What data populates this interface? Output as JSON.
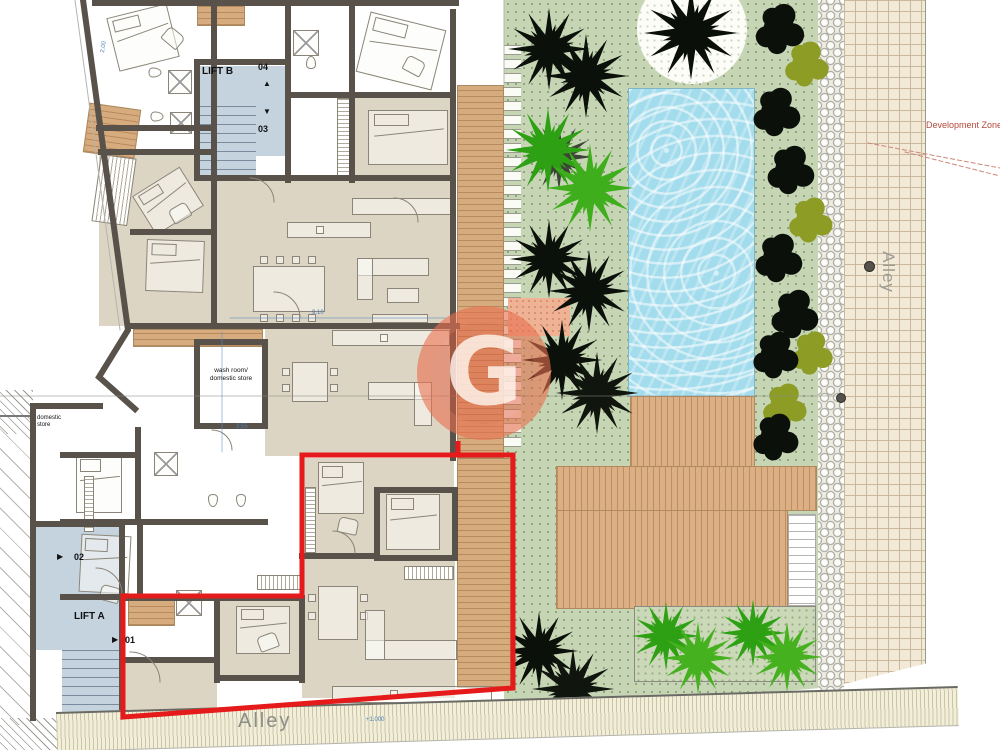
{
  "plan": {
    "lifts": {
      "a": "LIFT A",
      "b": "LIFT B"
    },
    "units": {
      "u1": "01",
      "u2": "02",
      "u3": "03",
      "u4": "04"
    },
    "rooms": {
      "domestic_store_l1": "domestic",
      "domestic_store_l2": "store",
      "wash_room_l1": "wash room/",
      "wash_room_l2": "domestic store"
    },
    "dimensions": {
      "d1": "2.00",
      "d2": "3.55",
      "d3": "9.10",
      "level_marker": "+1.000"
    }
  },
  "site": {
    "alley_vertical": "Alley",
    "alley_bottom": "Alley",
    "development_zone": "Development Zone"
  },
  "watermark": {
    "letter": "G"
  },
  "icons": {
    "up_arrow": "▲",
    "down_arrow": "▼",
    "right_arrow": "▶"
  },
  "colors": {
    "red_outline": "#E51A1A",
    "pool": "#A3DCEC",
    "garden_green": "#C6D6B4",
    "deck_wood": "#DCB084",
    "dark_tree": "#0B100B",
    "olive_tree": "#8D9C25",
    "bright_palm": "#33A317",
    "wall": "#59524B",
    "lift_blue": "#C5D3DE",
    "watermark_red": "rgba(228,92,60,0.5)"
  }
}
